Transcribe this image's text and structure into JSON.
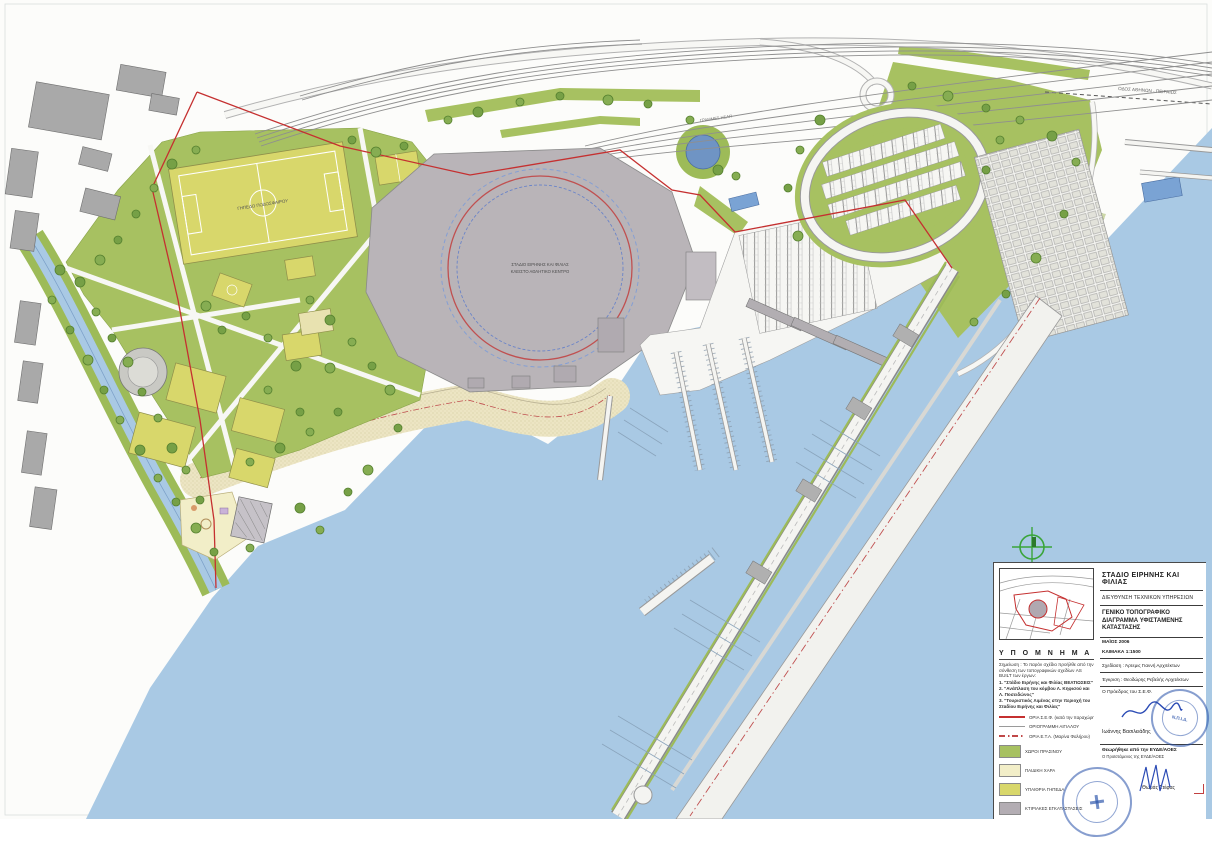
{
  "title_block": {
    "project_title": "ΣΤΑΔΙΟ ΕΙΡΗΝΗΣ ΚΑΙ ΦΙΛΙΑΣ",
    "department": "ΔΙΕΥΘΥΝΣΗ ΤΕΧΝΙΚΩΝ ΥΠΗΡΕΣΙΩΝ",
    "drawing_title": "ΓΕΝΙΚΟ ΤΟΠΟΓΡΑΦΙΚΟ ΔΙΑΓΡΑΜΜΑ ΥΦΙΣΤΑΜΕΝΗΣ ΚΑΤΑΣΤΑΣΗΣ",
    "date": "ΜΑΪΟΣ 2006",
    "scale": "ΚΛΙΜΑΚΑ 1:1500",
    "drafting_credit": "Σχεδίαση :  Άρτεμις Γιαννή      Αρχιτέκτων",
    "approval_credit": "Έγκριση :  Θεοδώρης Ρεβελής    Αρχιτέκτων",
    "president_label": "Ο Πρόεδρος του Σ.Ε.Φ.",
    "president_name": "Ιωάννης Βασιλειάδης",
    "reviewed_label": "Θεωρήθηκε από την ΕΥΔΕ/ΑΟΕΣ",
    "reviewed_sub_label": "Ο Προϊστάμενος της ΕΥΔΕ/ΑΟΕΣ",
    "reviewer_name": "Θωμάς Στέφας",
    "stamp_center_text": "Ν.Π.Ι.Δ."
  },
  "legend": {
    "heading": "Υ Π Ο Μ Ν Η Μ Α",
    "note": "Σημείωση : Το παρόν σχέδιο προήλθε από την σύνθεση των τοπογραφικών σχεδίων AS BUILT των έργων:",
    "note_items": [
      "1. \"Στάδιο Ειρήνης και Φιλίας ΒΕΛΤΙΩΣΕΙΣ\"",
      "2. \"Ανάπλαση του κόμβου Λ. Κηφισού και Λ. Ποσειδώνος\"",
      "3. \"Τουριστικός Λιμένας στην περιοχή του Σταδίου Ειρήνης και Φιλίας\""
    ],
    "line_items": [
      {
        "label": "ΟΡΙΑ Σ.Ε.Φ. (κατά την παραχώρηση)",
        "style": "solid",
        "color": "#c53030"
      },
      {
        "label": "ΟΡΙΟΓΡΑΜΜΗ ΑΙΓΙΑΛΟΥ",
        "style": "solid",
        "color": "#9a9a9a"
      },
      {
        "label": "ΟΡΙΑ Ε.Τ.Α. (Μαρίνα Φαλήρου)",
        "style": "dash-dot",
        "color": "#c04848"
      }
    ],
    "area_items": [
      {
        "label": "ΧΩΡΟΙ ΠΡΑΣΙΝΟΥ",
        "color": "#a7c161",
        "css": "background:#a7c161"
      },
      {
        "label": "ΠΑΙΔΙΚΗ ΧΑΡΑ",
        "color": "#f2eec8",
        "css": "background:#f2eec8"
      },
      {
        "label": "ΥΠΑΙΘΡΙΑ ΓΗΠΕΔΑ",
        "color": "#d8d76b",
        "css": "background:#d8d76b"
      },
      {
        "label": "ΚΤΙΡΙΑΚΕΣ ΕΓΚΑΤΑΣΤΑΣΕΙΣ",
        "color": "#b3adb3",
        "css": "background:#b3adb3"
      }
    ]
  },
  "map_labels": {
    "stadium_line1": "ΣΤΑΔΙΟ ΕΙΡΗΝΗΣ ΚΑΙ ΦΙΛΙΑΣ",
    "stadium_line2": "ΚΛΕΙΣΤΟ ΑΘΛΗΤΙΚΟ ΚΕΝΤΡΟ",
    "football_field": "ΓΗΠΕΔΟ ΠΟΔΟΣΦΑΙΡΟΥ",
    "road_top": "ΟΔΟΣ ΑΘΗΝΩΝ - ΠΕΙΡΑΙΩΣ",
    "railway": "ΓΡΑΜΜΕΣ ΗΣΑΠ"
  },
  "colors": {
    "sea": "#a9c9e4",
    "green": "#a7c161",
    "field": "#d8d76b",
    "playground": "#f2eec8",
    "building": "#b3adb3",
    "sand": "#ece5c3",
    "boundary_red": "#c53030",
    "stamp_blue": "#244ea8"
  }
}
